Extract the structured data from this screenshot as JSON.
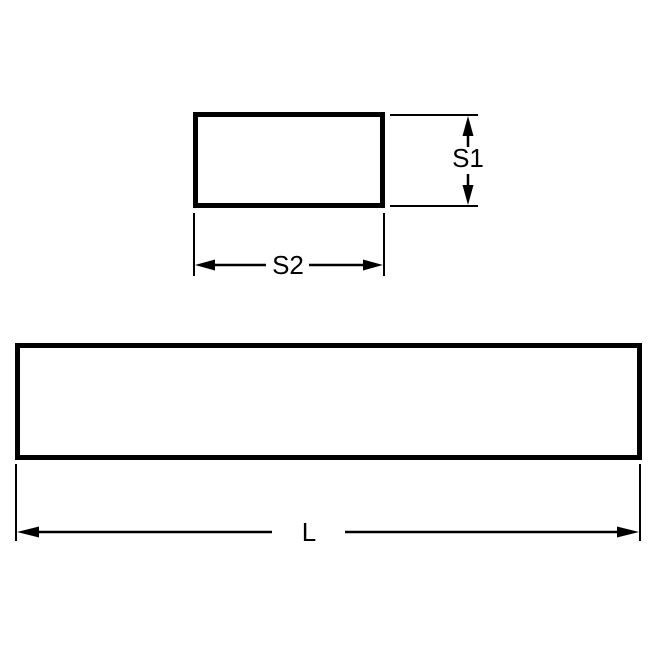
{
  "colors": {
    "line": "#000000",
    "background": "#ffffff"
  },
  "views": {
    "cross_section": {
      "dimensions": {
        "height_label": "S1",
        "width_label": "S2"
      }
    },
    "side_view": {
      "dimensions": {
        "length_label": "L"
      }
    }
  }
}
